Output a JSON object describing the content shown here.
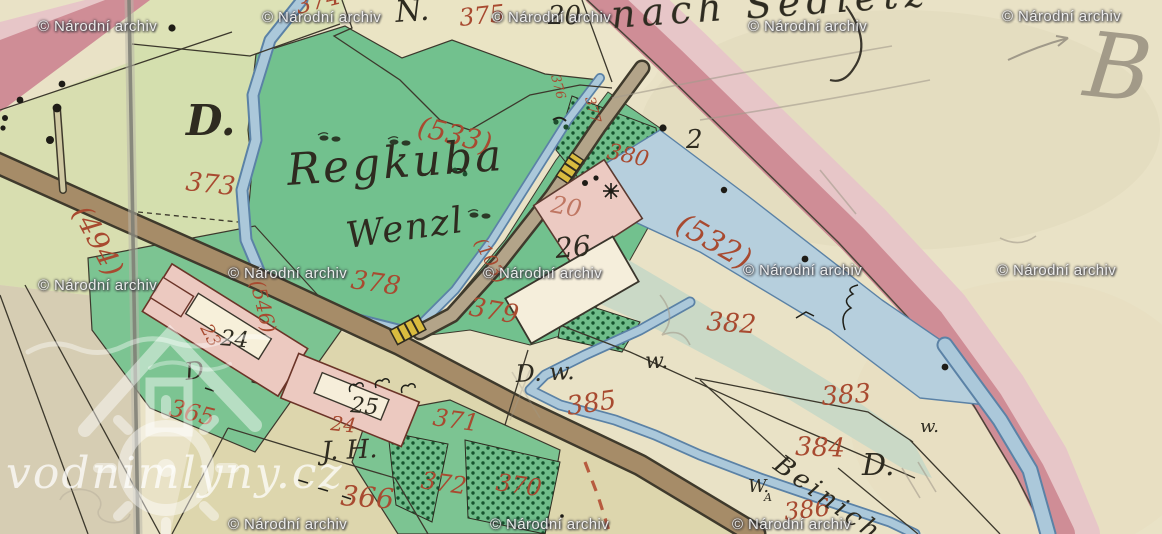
{
  "watermark": {
    "archive": "© Národní archiv",
    "site": "vodnimlyny.cz"
  },
  "place_names": {
    "meadow_name": "Regkuba",
    "meadow_name2": "Wenzl",
    "direction_note": "nach Sedletz",
    "stream_name": "Beinich",
    "pencil_note": "B"
  },
  "road_numbers": {
    "r494": "(494)",
    "r533": "(533)",
    "r532": "(532)",
    "r546": "(546)",
    "r103": "(103)"
  },
  "parcel_numbers": {
    "p365": "365",
    "p366": "366",
    "p370": "370",
    "p371": "371",
    "p372": "372",
    "p373": "373",
    "p374": "374",
    "p375": "375",
    "p376": "376",
    "p377": "377",
    "p378": "378",
    "p379": "379",
    "p380": "380",
    "p382": "382",
    "p383": "383",
    "p384": "384",
    "p385": "385",
    "p386": "386",
    "p20_old": "20",
    "p23_old": "23",
    "p24_old": "24"
  },
  "house_numbers": {
    "n_label": "N.",
    "n20": "20",
    "n2": "2",
    "h24": "24",
    "h25": "25",
    "h26": "26"
  },
  "letters": {
    "d_large": "D.",
    "d_small": "D.",
    "d_hand": "D",
    "dw": "D. w.",
    "w1": "w.",
    "w2": "w.",
    "w3": "W.",
    "w3_sub": "A",
    "jh": "J. H."
  },
  "colors": {
    "paper_beige": "#e9e2c6",
    "meadow_green": "#72c18e",
    "orchard_dot_green": "#14532d",
    "road_pink": "#cf8d96",
    "road_pink_light": "#e7c6c8",
    "stream_blue": "#abc8da",
    "road_brown": "#a68c68",
    "building_pink": "#ecc9c0",
    "number_red": "#a84a30",
    "ink_black": "#2e2b20",
    "pencil_grey": "#a39b8c"
  }
}
